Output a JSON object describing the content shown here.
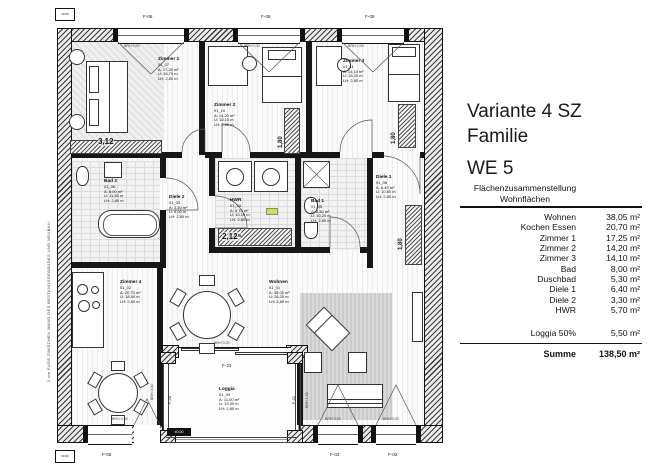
{
  "panel": {
    "title_line1": "Variante 4 SZ",
    "title_line2": "Familie",
    "unit": "WE 5",
    "header_line1": "Flächenzusammenstellung",
    "header_line2": "Wohnflächen",
    "rows": [
      {
        "label": "Wohnen",
        "value": "38,05 m²"
      },
      {
        "label": "Kochen Essen",
        "value": "20,70 m²"
      },
      {
        "label": "Zimmer 1",
        "value": "17,25 m²"
      },
      {
        "label": "Zimmer 2",
        "value": "14,20 m²"
      },
      {
        "label": "Zimmer 3",
        "value": "14,10 m²"
      },
      {
        "label": "Bad",
        "value": "8,00 m²"
      },
      {
        "label": "Duschbad",
        "value": "5,30 m²"
      },
      {
        "label": "Diele 1",
        "value": "6,40 m²"
      },
      {
        "label": "Diele 2",
        "value": "3,30 m²"
      },
      {
        "label": "HWR",
        "value": "5,70 m²"
      }
    ],
    "loggia_row": {
      "label": "Loggia 50%",
      "value": "5,50 m²"
    },
    "sum_row": {
      "label": "Summe",
      "value": "138,50 m²"
    }
  },
  "plan": {
    "rooms": {
      "z1": {
        "name": "Zimmer 1",
        "num": "01_07",
        "a": "A:  17,25 m²",
        "u": "U: 16,70 m",
        "lh": "LH: 2,80 m"
      },
      "z2": {
        "name": "Zimmer 2",
        "num": "01_10",
        "a": "A:  14,20 m²",
        "u": "U: 15,10 m",
        "lh": "LH: 2,80 m"
      },
      "z3": {
        "name": "Zimmer 3",
        "num": "01_11",
        "a": "A:  14,10 m²",
        "u": "U: 15,20 m",
        "lh": "LH: 2,80 m"
      },
      "z4": {
        "name": "Zimmer 4",
        "num": "01_02",
        "a": "A:  20,70 m²",
        "u": "U: 18,50 m",
        "lh": "LH: 2,80 m"
      },
      "bad2": {
        "name": "Bad 2",
        "num": "01_06",
        "a": "A:  8,00 m²",
        "u": "U: 11,50 m",
        "lh": "LH: 2,80 m"
      },
      "bad1": {
        "name": "Bad 1",
        "num": "01_05",
        "a": "A:  5,30 m²",
        "u": "U: 10,20 m",
        "lh": "LH: 2,80 m"
      },
      "diele1": {
        "name": "Diele 1",
        "num": "01_08",
        "a": "A:  6,40 m²",
        "u": "U: 10,80 m",
        "lh": "LH: 2,80 m"
      },
      "diele2": {
        "name": "Diele 2",
        "num": "01_03",
        "a": "A:  3,30 m²",
        "u": "U: 8,00 m",
        "lh": "LH: 2,80 m"
      },
      "hwr": {
        "name": "HWR",
        "num": "01_04",
        "a": "A:  5,70 m²",
        "u": "U: 10,10 m",
        "lh": "LH: 2,80 m"
      },
      "wohnen": {
        "name": "Wohnen",
        "num": "01_01",
        "a": "A:  38,05 m²",
        "u": "U: 26,20 m",
        "lh": "LH: 2,80 m"
      },
      "loggia": {
        "name": "Loggia",
        "num": "01_09",
        "a": "A:  11,00 m²",
        "u": "U: 13,30 m",
        "lh": "LH: 2,80 m"
      }
    },
    "tags": {
      "f06": "F-06",
      "f08": "F-08",
      "f09": "F-09",
      "f05": "F-05",
      "f03": "F-03",
      "f02": "F-02",
      "f23": "F-23",
      "f26": "F-26",
      "f22": "F-22"
    },
    "brh": {
      "b000": "BRH 0,00",
      "b135": "BRH 1,35"
    },
    "dims": {
      "d312": "3,12",
      "d2125": "2,12⁵",
      "d180": "1,80"
    },
    "fuge": "2 cm FUGE ZWISCHEN WAND DES BESTANDSGEBÄUDES UND NEUBAU",
    "marker": "±0,00",
    "colors": {
      "highlight": "#d6dd4f",
      "ink": "#111111"
    }
  }
}
